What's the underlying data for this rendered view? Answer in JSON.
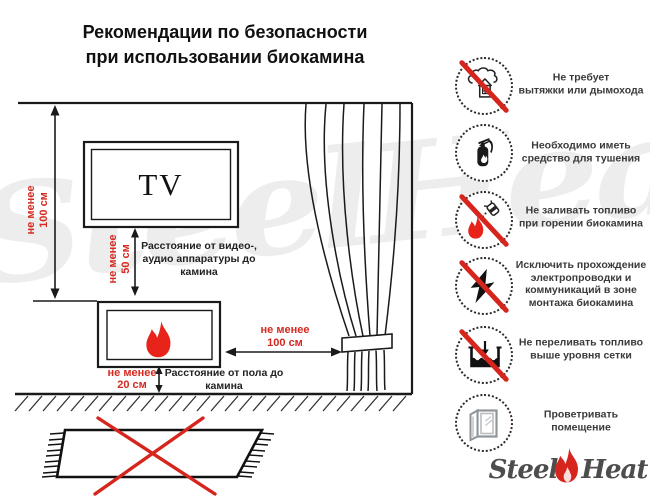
{
  "title": "Рекомендации по безопасности\nпри использовании биокамина",
  "diagram": {
    "tv_label": "TV",
    "dim_ceiling_to_fireplace": "не менее\n100 см",
    "dim_tv_to_fireplace": "не менее\n50 см",
    "label_tv_distance": "Расстояние от видео-,\nаудио аппаратуры до\nкамина",
    "dim_fireplace_to_curtain": "не менее\n100 см",
    "dim_floor_to_fireplace": "не менее\n20 см",
    "label_floor_distance": "Расстояние от пола до\nкамина"
  },
  "rules": [
    {
      "icon": "no-chimney-icon",
      "crossed": true,
      "text": "Не требует\nвытяжки или дымохода"
    },
    {
      "icon": "extinguisher-icon",
      "crossed": false,
      "text": "Необходимо иметь\nсредство для тушения"
    },
    {
      "icon": "no-refill-burning-icon",
      "crossed": true,
      "text": "Не заливать топливо\nпри горении биокамина"
    },
    {
      "icon": "no-wiring-icon",
      "crossed": true,
      "text": "Исключить прохождение\nэлектропроводки и\nкоммуникаций в зоне\nмонтажа биокамина"
    },
    {
      "icon": "no-overfill-icon",
      "crossed": true,
      "text": "Не переливать топливо\nвыше уровня сетки"
    },
    {
      "icon": "ventilate-icon",
      "crossed": false,
      "text": "Проветривать\nпомещение"
    }
  ],
  "watermark": "SteelHeat",
  "logo": {
    "part1": "Steel",
    "part2": "Heat"
  },
  "colors": {
    "accent_red": "#d42a20",
    "flame_red": "#e8231a",
    "line_black": "#1a1a1a",
    "text_dark": "#3a3a3a"
  }
}
